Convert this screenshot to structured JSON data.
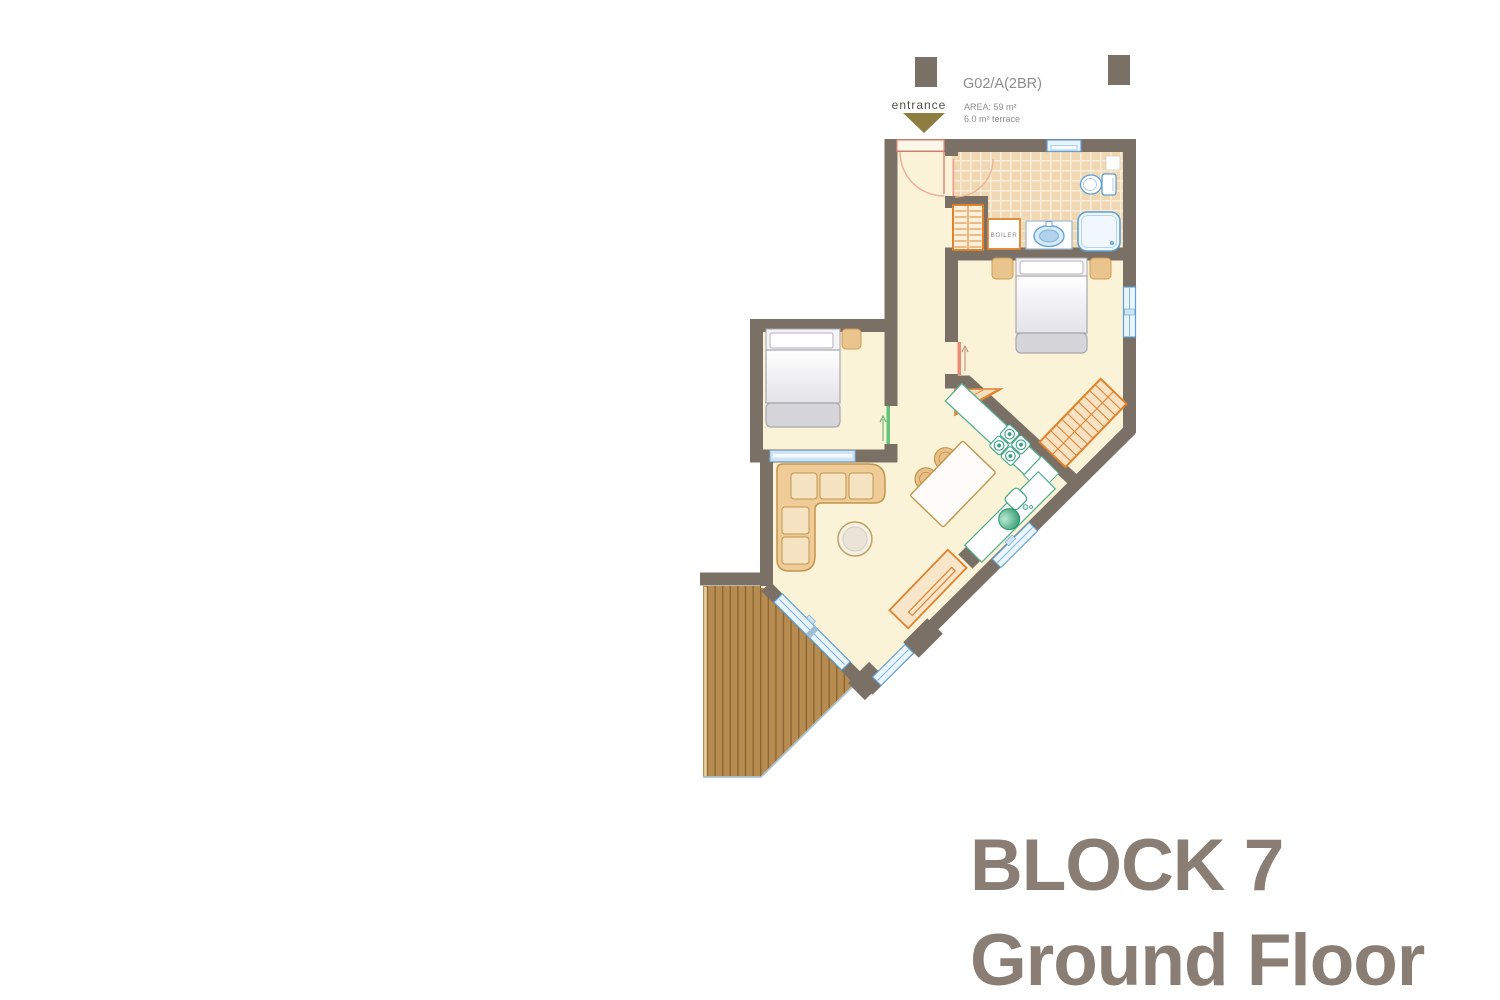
{
  "header": {
    "entrance_label": "entrance",
    "unit_id": "G02/A(2BR)",
    "area_line": "AREA: 59 m²",
    "terrace_line": "6.0 m² terrace"
  },
  "plan": {
    "boiler_label": "BOILER"
  },
  "title": {
    "line1": "BLOCK 7",
    "line2": "Ground Floor"
  },
  "colors": {
    "wall": "#7b7065",
    "floor": "#faf3d8",
    "tile": "#f0d8b2",
    "wood": "#b78c51",
    "wood_line": "#8a6331",
    "accent_orange": "#e0812c",
    "fixture_blue": "#5e9fd4",
    "window_fill": "#eaf4fc",
    "kitchen_green": "#3da583",
    "door_red": "#ee8a77",
    "door_green": "#63c677",
    "furniture_tan": "#eac48d",
    "bed_gray": "#d6d6da",
    "label_gray": "#8e8e8e",
    "entrance_text": "#55504a",
    "arrow_olive": "#8e7c40",
    "title_color": "#8a7e74"
  }
}
